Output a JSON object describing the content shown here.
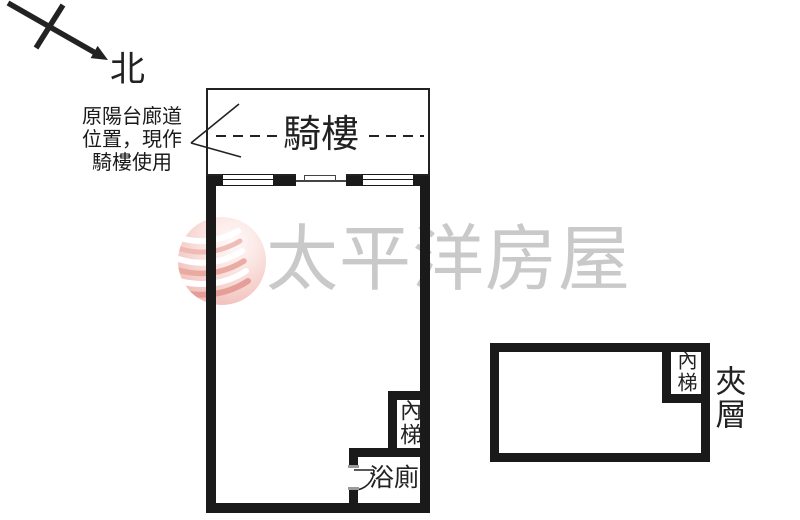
{
  "compass": {
    "label": "北"
  },
  "annotation": {
    "lines": [
      "原陽台廊道",
      "位置，現作",
      "騎樓使用"
    ]
  },
  "arcade": {
    "label": "騎樓"
  },
  "main_unit": {
    "stairs_label": "內梯",
    "bathroom_label": "浴廁"
  },
  "mezzanine": {
    "label": "夾層",
    "stairs_label": "內梯"
  },
  "watermark": {
    "brand": "太平洋房屋"
  },
  "colors": {
    "wall": "#1a1a1a",
    "line": "#222222",
    "watermark_text": "#c9c9c9",
    "jamb": "#9a9a9a"
  }
}
